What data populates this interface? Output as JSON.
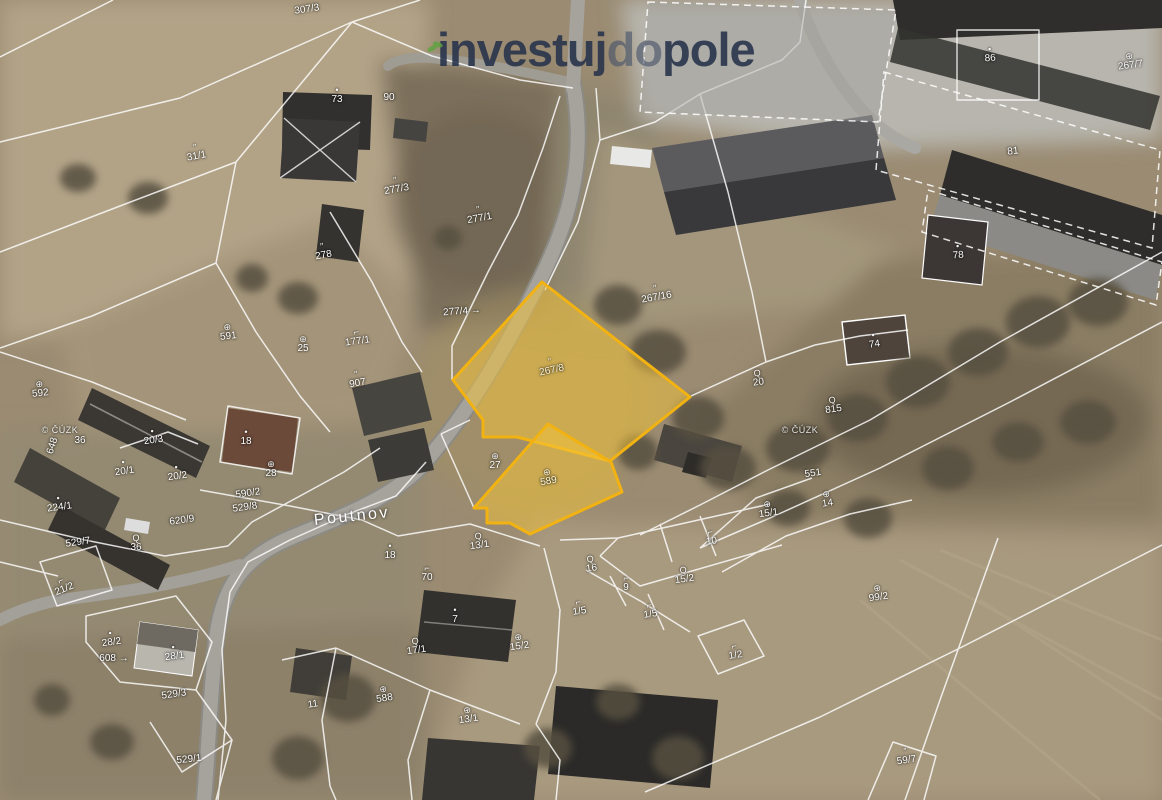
{
  "brand": {
    "part1": "investuj",
    "part2": "do",
    "part3": "pole"
  },
  "map": {
    "street_label": "Poutnov",
    "copyright": "© ČÚZK",
    "highlighted_parcels": [
      "267/8",
      "589"
    ],
    "labels": [
      {
        "t": "307/3",
        "x": 307,
        "y": 10,
        "s": "none",
        "r": -8
      },
      {
        "t": "73",
        "x": 337,
        "y": 96,
        "s": "dot",
        "r": 0
      },
      {
        "t": "90",
        "x": 389,
        "y": 98,
        "s": "none",
        "r": 0
      },
      {
        "t": "31/1",
        "x": 196,
        "y": 153,
        "s": "grass",
        "r": -10
      },
      {
        "t": "277/3",
        "x": 396,
        "y": 186,
        "s": "grass",
        "r": -10
      },
      {
        "t": "277/1",
        "x": 479,
        "y": 215,
        "s": "grass",
        "r": -10
      },
      {
        "t": "278",
        "x": 323,
        "y": 252,
        "s": "grass",
        "r": -10
      },
      {
        "t": "277/4 →",
        "x": 462,
        "y": 312,
        "s": "none",
        "r": -4
      },
      {
        "t": "267/16",
        "x": 656,
        "y": 294,
        "s": "grass",
        "r": -10
      },
      {
        "t": "267/7",
        "x": 1130,
        "y": 62,
        "s": "orchard",
        "r": -8
      },
      {
        "t": "86",
        "x": 990,
        "y": 55,
        "s": "dot",
        "r": -4
      },
      {
        "t": "81",
        "x": 1013,
        "y": 152,
        "s": "none",
        "r": -6
      },
      {
        "t": "78",
        "x": 958,
        "y": 252,
        "s": "dot",
        "r": -4
      },
      {
        "t": "267/8",
        "x": 551,
        "y": 367,
        "s": "grass",
        "r": -12,
        "cls": "hl",
        "name": "highlighted-parcel-label-main"
      },
      {
        "t": "589",
        "x": 548,
        "y": 478,
        "s": "orchard",
        "r": -10,
        "cls": "hl",
        "name": "highlighted-parcel-label-secondary"
      },
      {
        "t": "591",
        "x": 228,
        "y": 333,
        "s": "orchard",
        "r": -6
      },
      {
        "t": "25",
        "x": 303,
        "y": 345,
        "s": "orchard",
        "r": 0
      },
      {
        "t": "177/1",
        "x": 357,
        "y": 338,
        "s": "hook",
        "r": -8
      },
      {
        "t": "907",
        "x": 357,
        "y": 380,
        "s": "grass",
        "r": -10
      },
      {
        "t": "592",
        "x": 40,
        "y": 390,
        "s": "orchard",
        "r": -6
      },
      {
        "t": "© ČÚZK",
        "x": 60,
        "y": 430,
        "s": "none",
        "r": 0,
        "cls": "wm",
        "name": "copyright-watermark"
      },
      {
        "t": "© ČÚZK",
        "x": 800,
        "y": 430,
        "s": "none",
        "r": 0,
        "cls": "wm",
        "name": "copyright-watermark"
      },
      {
        "t": "648",
        "x": 53,
        "y": 446,
        "s": "none",
        "r": -72
      },
      {
        "t": "36",
        "x": 80,
        "y": 441,
        "s": "none",
        "r": 0
      },
      {
        "t": "20/3",
        "x": 153,
        "y": 437,
        "s": "dot",
        "r": -8
      },
      {
        "t": "18",
        "x": 246,
        "y": 438,
        "s": "dot",
        "r": 0
      },
      {
        "t": "20/1",
        "x": 124,
        "y": 468,
        "s": "dot",
        "r": -8
      },
      {
        "t": "20/2",
        "x": 177,
        "y": 473,
        "s": "dot",
        "r": -8
      },
      {
        "t": "27",
        "x": 495,
        "y": 462,
        "s": "orchard",
        "r": 0
      },
      {
        "t": "28",
        "x": 271,
        "y": 470,
        "s": "orchard",
        "r": 0
      },
      {
        "t": "224/1",
        "x": 59,
        "y": 504,
        "s": "dot",
        "r": -8
      },
      {
        "t": "590/2",
        "x": 248,
        "y": 494,
        "s": "none",
        "r": -8
      },
      {
        "t": "529/8",
        "x": 245,
        "y": 508,
        "s": "none",
        "r": -8
      },
      {
        "t": "620/9",
        "x": 182,
        "y": 521,
        "s": "none",
        "r": -8
      },
      {
        "t": "529/7",
        "x": 78,
        "y": 543,
        "s": "none",
        "r": -8
      },
      {
        "t": "36",
        "x": 136,
        "y": 544,
        "s": "circle",
        "r": 0
      },
      {
        "t": "21/2",
        "x": 63,
        "y": 586,
        "s": "hook",
        "r": -22
      },
      {
        "t": "28/2",
        "x": 111,
        "y": 639,
        "s": "dot",
        "r": -8
      },
      {
        "t": "608 →",
        "x": 114,
        "y": 659,
        "s": "none",
        "r": 0
      },
      {
        "t": "28/1",
        "x": 174,
        "y": 653,
        "s": "dot",
        "r": -8
      },
      {
        "t": "529/3",
        "x": 174,
        "y": 695,
        "s": "none",
        "r": -8
      },
      {
        "t": "529/1",
        "x": 189,
        "y": 760,
        "s": "none",
        "r": -6
      },
      {
        "t": "Poutnov",
        "x": 352,
        "y": 517,
        "s": "none",
        "r": -6,
        "cls": "street",
        "name": "street-label"
      },
      {
        "t": "18",
        "x": 390,
        "y": 552,
        "s": "dot",
        "r": 0
      },
      {
        "t": "13/1",
        "x": 479,
        "y": 542,
        "s": "circle",
        "r": -8
      },
      {
        "t": "70",
        "x": 427,
        "y": 574,
        "s": "hook",
        "r": 0
      },
      {
        "t": "7",
        "x": 455,
        "y": 616,
        "s": "dot",
        "r": 0
      },
      {
        "t": "17/1",
        "x": 416,
        "y": 647,
        "s": "circle",
        "r": -8
      },
      {
        "t": "15/2",
        "x": 519,
        "y": 643,
        "s": "orchard",
        "r": -8
      },
      {
        "t": "588",
        "x": 384,
        "y": 695,
        "s": "orchard",
        "r": -8
      },
      {
        "t": "11",
        "x": 313,
        "y": 705,
        "s": "none",
        "r": -8
      },
      {
        "t": "13/1",
        "x": 468,
        "y": 716,
        "s": "orchard",
        "r": -8
      },
      {
        "t": "16",
        "x": 591,
        "y": 565,
        "s": "circle",
        "r": -8
      },
      {
        "t": "10",
        "x": 711,
        "y": 538,
        "s": "hook",
        "r": -8
      },
      {
        "t": "15/2",
        "x": 684,
        "y": 576,
        "s": "circle",
        "r": -8
      },
      {
        "t": "9",
        "x": 626,
        "y": 584,
        "s": "hook",
        "r": 0
      },
      {
        "t": "1/5",
        "x": 579,
        "y": 608,
        "s": "hook",
        "r": -8
      },
      {
        "t": "1/5",
        "x": 650,
        "y": 611,
        "s": "hook",
        "r": -8
      },
      {
        "t": "1/2",
        "x": 735,
        "y": 652,
        "s": "hook",
        "r": -8
      },
      {
        "t": "74",
        "x": 874,
        "y": 341,
        "s": "dot",
        "r": -8
      },
      {
        "t": "20",
        "x": 758,
        "y": 379,
        "s": "circle",
        "r": -8
      },
      {
        "t": "815",
        "x": 833,
        "y": 406,
        "s": "circle",
        "r": -8
      },
      {
        "t": "551",
        "x": 813,
        "y": 474,
        "s": "none",
        "r": -8
      },
      {
        "t": "15/1",
        "x": 768,
        "y": 510,
        "s": "orchard",
        "r": -8
      },
      {
        "t": "14",
        "x": 827,
        "y": 500,
        "s": "orchard",
        "r": -8
      },
      {
        "t": "99/2",
        "x": 878,
        "y": 594,
        "s": "orchard",
        "r": -8
      },
      {
        "t": "59/7",
        "x": 906,
        "y": 757,
        "s": "grass",
        "r": -8
      }
    ]
  },
  "icons": {
    "grass": "grass-symbol",
    "orchard": "orchard-symbol",
    "circle": "scrub-symbol",
    "hook": "yard-symbol",
    "dot": "building-dot"
  },
  "colors": {
    "highlight_fill": "#F4C33C",
    "highlight_stroke": "#F2B312",
    "logo_dark": "#26314A",
    "logo_light": "#465269",
    "logo_green": "#5CA33E",
    "parcel_line": "#FFFFFF"
  }
}
